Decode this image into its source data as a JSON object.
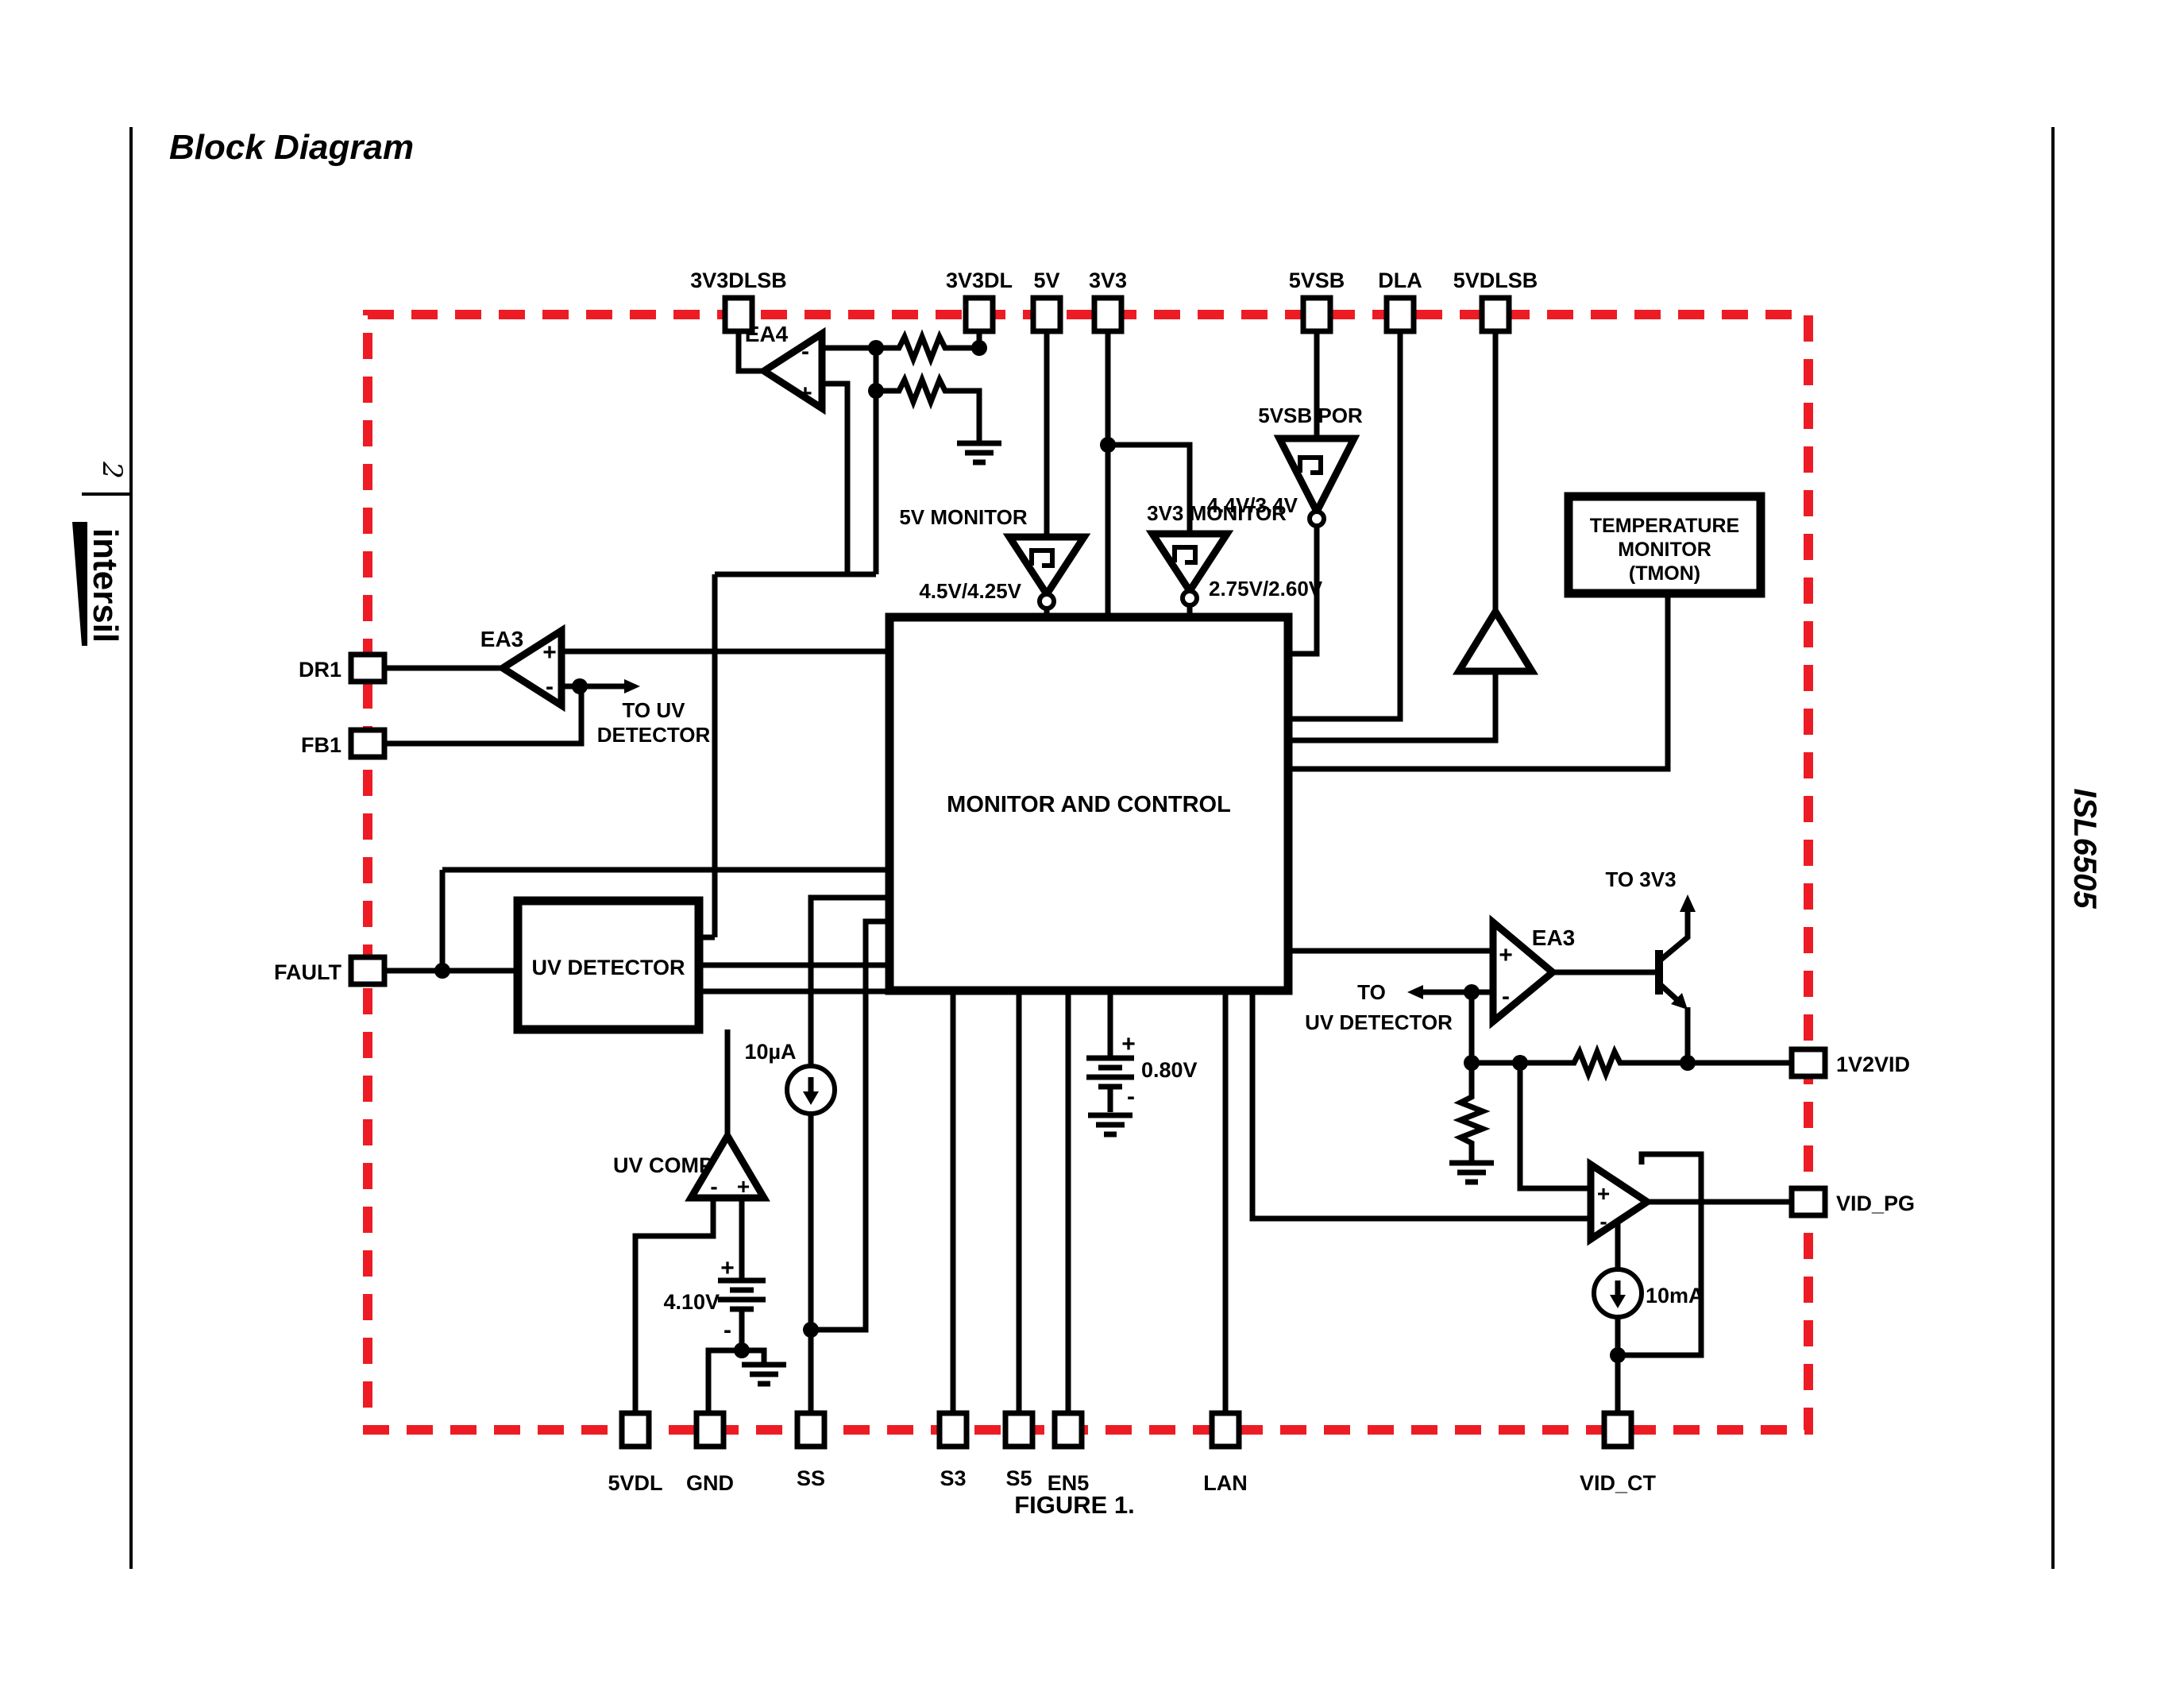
{
  "page": {
    "title": "Block Diagram",
    "figure": "FIGURE 1.",
    "page_number": "2",
    "brand": "intersil",
    "part": "ISL6505"
  },
  "pins": {
    "top": [
      "3V3DLSB",
      "3V3DL",
      "5V",
      "3V3",
      "5VSB",
      "DLA",
      "5VDLSB"
    ],
    "left": [
      "DR1",
      "FB1",
      "FAULT"
    ],
    "right": [
      "1V2VID",
      "VID_PG"
    ],
    "bottom": [
      "5VDL",
      "GND",
      "SS",
      "S3",
      "S5",
      "EN5",
      "LAN",
      "VID_CT"
    ]
  },
  "blocks": {
    "monitor_control": "MONITOR AND CONTROL",
    "uv_detector": "UV DETECTOR",
    "tmon": [
      "TEMPERATURE",
      "MONITOR",
      "(TMON)"
    ]
  },
  "comps": {
    "por": {
      "label": "5VSB POR",
      "thresh": "4.4V/3.4V"
    },
    "mon5": {
      "label": "5V MONITOR",
      "thresh": "4.5V/4.25V"
    },
    "mon3": {
      "label": "3V3 MONITOR",
      "thresh": "2.75V/2.60V"
    },
    "uvcomp": {
      "label": "UV COMP",
      "ref": "4.10V"
    },
    "vid": {
      "ref": "0.80V"
    }
  },
  "amps": {
    "ea4": "EA4",
    "ea3l": "EA3",
    "ea3r": "EA3"
  },
  "sources": {
    "iss": "10µA",
    "ivid": "10mA"
  },
  "notes": {
    "to_uv_l1": "TO UV",
    "to_uv_l2": "DETECTOR",
    "to_uv_r1": "TO",
    "to_uv_r2": "UV DETECTOR",
    "to3v3": "TO 3V3"
  },
  "signs": {
    "plus": "+",
    "minus": "-"
  },
  "colors": {
    "accent": "#ed1c24",
    "ink": "#000000"
  }
}
